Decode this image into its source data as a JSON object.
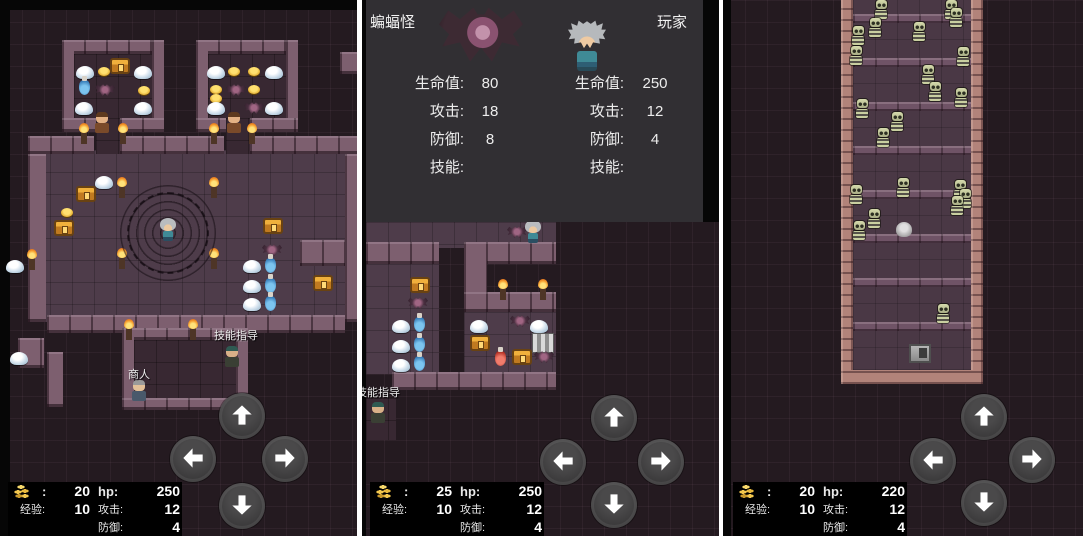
{
  "colors": {
    "gold": "#e8b93e",
    "battle_panel_bg": "#312f33",
    "map_bg": "#241a20",
    "wall": "#7d5f6f",
    "corridor_wall": "#b2837a"
  },
  "icons": {
    "gold": "coin-stack-icon",
    "dpad": [
      "up-arrow-icon",
      "left-arrow-icon",
      "right-arrow-icon",
      "down-arrow-icon"
    ]
  },
  "panels": [
    {
      "name": "dungeon-hall",
      "stats": {
        "gold_colon": ":",
        "gold": "20",
        "hp_label": "hp:",
        "hp": "250",
        "exp_label": "经验:",
        "exp": "10",
        "atk_label": "攻击:",
        "atk": "12",
        "def_label": "防御:",
        "def": "4"
      },
      "scene": {
        "rects": [
          [
            "r-black",
            0,
            0,
            10,
            536
          ],
          [
            "r-black",
            10,
            0,
            347,
            10
          ],
          [
            "r-floor",
            28,
            150,
            317,
            172
          ],
          [
            "r-wall",
            28,
            136,
            66,
            18
          ],
          [
            "r-wall",
            120,
            136,
            104,
            18
          ],
          [
            "r-wall",
            250,
            136,
            107,
            18
          ],
          [
            "r-floor-dark",
            96,
            118,
            24,
            36
          ],
          [
            "r-floor-dark",
            226,
            118,
            24,
            36
          ],
          [
            "r-wall",
            62,
            40,
            102,
            14
          ],
          [
            "r-wall",
            62,
            40,
            12,
            92
          ],
          [
            "r-wall",
            152,
            40,
            12,
            92
          ],
          [
            "r-wall",
            62,
            118,
            34,
            14
          ],
          [
            "r-wall",
            120,
            118,
            44,
            14
          ],
          [
            "r-floor-dark",
            74,
            54,
            78,
            64
          ],
          [
            "r-wall",
            196,
            40,
            102,
            14
          ],
          [
            "r-wall",
            196,
            40,
            12,
            92
          ],
          [
            "r-wall",
            286,
            40,
            12,
            92
          ],
          [
            "r-wall",
            196,
            118,
            30,
            14
          ],
          [
            "r-wall",
            250,
            118,
            48,
            14
          ],
          [
            "r-floor-dark",
            208,
            54,
            78,
            64
          ],
          [
            "r-wall",
            28,
            154,
            18,
            168
          ],
          [
            "r-wall",
            340,
            52,
            17,
            22
          ],
          [
            "r-wall",
            300,
            240,
            45,
            26
          ],
          [
            "r-wall",
            345,
            154,
            12,
            168
          ],
          [
            "r-wall",
            47,
            315,
            298,
            18
          ],
          [
            "r-wall",
            18,
            338,
            26,
            30
          ],
          [
            "r-wall",
            47,
            352,
            16,
            55
          ],
          [
            "r-wall",
            122,
            328,
            126,
            12
          ],
          [
            "r-wall",
            122,
            328,
            12,
            80
          ],
          [
            "r-wall",
            236,
            340,
            12,
            56
          ],
          [
            "r-floor-dark",
            134,
            340,
            102,
            58
          ],
          [
            "r-wall",
            122,
            398,
            126,
            12
          ]
        ],
        "sprites": [
          [
            "slime",
            76,
            66
          ],
          [
            "coin",
            98,
            67
          ],
          [
            "chest",
            110,
            58
          ],
          [
            "slime",
            134,
            66
          ],
          [
            "potion-blue",
            79,
            80
          ],
          [
            "bat",
            95,
            84
          ],
          [
            "coin",
            138,
            86
          ],
          [
            "slime",
            75,
            102
          ],
          [
            "slime",
            134,
            102
          ],
          [
            "slime",
            207,
            66
          ],
          [
            "coin",
            228,
            67
          ],
          [
            "coin",
            248,
            67
          ],
          [
            "slime",
            265,
            66
          ],
          [
            "coin",
            210,
            85
          ],
          [
            "bat",
            226,
            84
          ],
          [
            "coin",
            248,
            85
          ],
          [
            "coin",
            210,
            94
          ],
          [
            "slime",
            207,
            102
          ],
          [
            "bat",
            244,
            102
          ],
          [
            "slime",
            265,
            102
          ],
          [
            "guard",
            94,
            112
          ],
          [
            "guard",
            226,
            112
          ],
          [
            "torch",
            81,
            132
          ],
          [
            "torch",
            120,
            132
          ],
          [
            "torch",
            211,
            132
          ],
          [
            "torch",
            249,
            132
          ],
          [
            "slime",
            95,
            176
          ],
          [
            "chest",
            76,
            186
          ],
          [
            "coin",
            61,
            208
          ],
          [
            "chest",
            54,
            220
          ],
          [
            "chest",
            263,
            218
          ],
          [
            "chest",
            313,
            275
          ],
          [
            "torch",
            119,
            186
          ],
          [
            "torch",
            211,
            186
          ],
          [
            "torch",
            119,
            257
          ],
          [
            "torch",
            211,
            257
          ],
          [
            "torch",
            29,
            258
          ],
          [
            "magic-circle",
            120,
            185
          ],
          [
            "player",
            160,
            218
          ],
          [
            "bat",
            262,
            244
          ],
          [
            "slime",
            243,
            260
          ],
          [
            "potion-blue",
            265,
            258
          ],
          [
            "slime",
            243,
            280
          ],
          [
            "potion-blue",
            265,
            278
          ],
          [
            "slime",
            243,
            298
          ],
          [
            "potion-blue",
            265,
            296
          ],
          [
            "slime",
            6,
            260
          ],
          [
            "slime",
            10,
            352
          ],
          [
            "torch",
            126,
            328
          ],
          [
            "torch",
            190,
            328
          ],
          [
            "npc-skill",
            224,
            346
          ],
          [
            "merchant",
            131,
            380
          ],
          [
            "btn-up",
            219,
            393
          ],
          [
            "btn-left",
            170,
            436
          ],
          [
            "btn-right",
            262,
            436
          ],
          [
            "btn-down",
            219,
            483
          ]
        ],
        "labels": [
          [
            "技能指导",
            214,
            327
          ],
          [
            "商人",
            128,
            366
          ]
        ]
      }
    },
    {
      "name": "battle-compare",
      "battle": {
        "left": {
          "name": "蝙蝠怪",
          "rows": [
            {
              "label": "生命值:",
              "value": "80"
            },
            {
              "label": "攻击:",
              "value": "18"
            },
            {
              "label": "防御:",
              "value": "8"
            },
            {
              "label": "技能:",
              "value": ""
            }
          ]
        },
        "right": {
          "name": "玩家",
          "rows": [
            {
              "label": "生命值:",
              "value": "250"
            },
            {
              "label": "攻击:",
              "value": "12"
            },
            {
              "label": "防御:",
              "value": "4"
            },
            {
              "label": "技能:",
              "value": ""
            }
          ]
        }
      },
      "stats": {
        "gold_colon": ":",
        "gold": "25",
        "hp_label": "hp:",
        "hp": "250",
        "exp_label": "经验:",
        "exp": "10",
        "atk_label": "攻击:",
        "atk": "12",
        "def_label": "防御:",
        "def": "4"
      },
      "scene": {
        "rects": [
          [
            "r-black",
            0,
            0,
            4,
            536
          ],
          [
            "r-black",
            341,
            0,
            16,
            222
          ],
          [
            "r-floor",
            4,
            222,
            190,
            26
          ],
          [
            "r-wall",
            4,
            242,
            73,
            22
          ],
          [
            "r-wall",
            102,
            242,
            92,
            22
          ],
          [
            "r-wall",
            102,
            242,
            23,
            70
          ],
          [
            "r-floor",
            4,
            264,
            73,
            110
          ],
          [
            "r-wall",
            102,
            292,
            92,
            20
          ],
          [
            "r-floor",
            102,
            312,
            92,
            60
          ],
          [
            "r-wall",
            30,
            372,
            164,
            18
          ],
          [
            "r-floor-dark",
            4,
            398,
            30,
            42
          ]
        ],
        "sprites": [
          [
            "bat",
            145,
            226
          ],
          [
            "player",
            163,
            220
          ],
          [
            "chest",
            48,
            277
          ],
          [
            "bat",
            46,
            297
          ],
          [
            "slime",
            30,
            320
          ],
          [
            "potion-blue",
            52,
            317
          ],
          [
            "slime",
            30,
            340
          ],
          [
            "potion-blue",
            52,
            337
          ],
          [
            "slime",
            30,
            359
          ],
          [
            "potion-blue",
            52,
            356
          ],
          [
            "torch",
            138,
            288
          ],
          [
            "torch",
            178,
            288
          ],
          [
            "slime",
            108,
            320
          ],
          [
            "bat",
            148,
            315
          ],
          [
            "slime",
            168,
            320
          ],
          [
            "chest",
            108,
            335
          ],
          [
            "stairs",
            170,
            333
          ],
          [
            "potion-red",
            133,
            351
          ],
          [
            "chest",
            150,
            349
          ],
          [
            "bat",
            172,
            351
          ],
          [
            "npc-skill",
            8,
            402
          ],
          [
            "btn-up",
            229,
            395
          ],
          [
            "btn-left",
            178,
            439
          ],
          [
            "btn-right",
            276,
            439
          ],
          [
            "btn-down",
            229,
            482
          ]
        ],
        "labels": [
          [
            "技能指导",
            -6,
            384
          ]
        ]
      }
    },
    {
      "name": "skeleton-corridor",
      "stats": {
        "gold_colon": ":",
        "gold": "20",
        "hp_label": "hp:",
        "hp": "220",
        "exp_label": "经验:",
        "exp": "10",
        "atk_label": "攻击:",
        "atk": "12",
        "def_label": "防御:",
        "def": "4"
      },
      "scene": {
        "rects": [
          [
            "r-black",
            0,
            0,
            8,
            536
          ],
          [
            "r-floor2",
            130,
            0,
            118,
            370
          ],
          [
            "r-strip",
            130,
            14,
            118,
            9
          ],
          [
            "r-strip",
            130,
            58,
            118,
            9
          ],
          [
            "r-strip",
            130,
            102,
            118,
            9
          ],
          [
            "r-strip",
            130,
            146,
            118,
            9
          ],
          [
            "r-strip",
            130,
            190,
            118,
            9
          ],
          [
            "r-strip",
            130,
            234,
            118,
            9
          ],
          [
            "r-strip",
            130,
            278,
            118,
            9
          ],
          [
            "r-strip",
            130,
            322,
            118,
            9
          ],
          [
            "r-wall-salmon",
            118,
            0,
            12,
            384
          ],
          [
            "r-wall-salmon",
            248,
            0,
            12,
            384
          ],
          [
            "r-wall-salmon",
            118,
            370,
            142,
            14
          ]
        ],
        "sprites": [
          [
            "skeleton",
            150,
            0
          ],
          [
            "skeleton",
            220,
            0
          ],
          [
            "skeleton",
            225,
            8
          ],
          [
            "skeleton",
            144,
            18
          ],
          [
            "skeleton",
            127,
            26
          ],
          [
            "skeleton",
            188,
            22
          ],
          [
            "skeleton",
            125,
            46
          ],
          [
            "skeleton",
            232,
            47
          ],
          [
            "skeleton",
            197,
            65
          ],
          [
            "skeleton",
            204,
            82
          ],
          [
            "skeleton",
            230,
            88
          ],
          [
            "skeleton",
            131,
            99
          ],
          [
            "skeleton",
            166,
            112
          ],
          [
            "skeleton",
            152,
            128
          ],
          [
            "skeleton",
            172,
            178
          ],
          [
            "skeleton",
            125,
            185
          ],
          [
            "skeleton",
            229,
            180
          ],
          [
            "skeleton",
            234,
            189
          ],
          [
            "skeleton",
            226,
            196
          ],
          [
            "skeleton",
            143,
            209
          ],
          [
            "skeleton",
            128,
            221
          ],
          [
            "ghost",
            173,
            222
          ],
          [
            "skeleton",
            212,
            304
          ],
          [
            "door",
            186,
            344
          ],
          [
            "btn-up",
            238,
            394
          ],
          [
            "btn-left",
            187,
            438
          ],
          [
            "btn-right",
            286,
            437
          ],
          [
            "btn-down",
            238,
            480
          ]
        ],
        "labels": []
      }
    }
  ]
}
